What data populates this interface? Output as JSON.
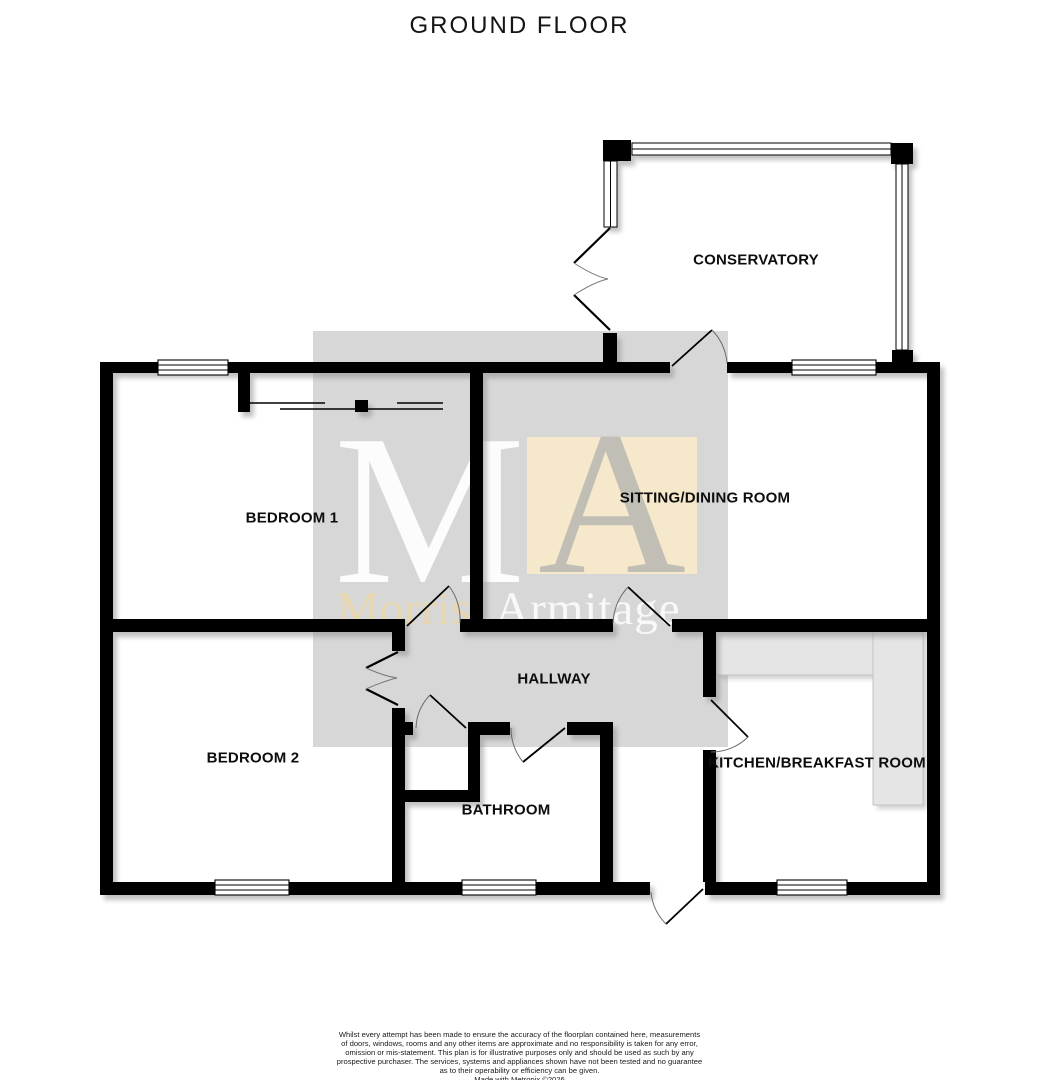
{
  "page": {
    "title": "GROUND FLOOR"
  },
  "rooms": {
    "conservatory": "CONSERVATORY",
    "sitting_dining": "SITTING/DINING ROOM",
    "bedroom1": "BEDROOM 1",
    "bedroom2": "BEDROOM 2",
    "hallway": "HALLWAY",
    "bathroom": "BATHROOM",
    "kitchen": "KITCHEN/BREAKFAST ROOM"
  },
  "watermark": {
    "letter_m": "M",
    "letter_a": "A",
    "name_first": "Morris",
    "name_last": "Armitage"
  },
  "colors": {
    "wall": "#000000",
    "watermark_gray": "#d7d7d7",
    "watermark_cream": "#f8e9ca",
    "counter": "#e5e5e5"
  },
  "disclaimer": {
    "line1": "Whilst every attempt has been made to ensure the accuracy of the floorplan contained here, measurements",
    "line2": "of doors, windows, rooms and any other items are approximate and no responsibility is taken for any error,",
    "line3": "omission or mis-statement. This plan is for illustrative purposes only and should be used as such by any",
    "line4": "prospective purchaser. The services, systems and appliances shown have not been tested and no guarantee",
    "line5": "as to their operability or efficiency can be given.",
    "credit": "Made with Metropix ©2026"
  }
}
